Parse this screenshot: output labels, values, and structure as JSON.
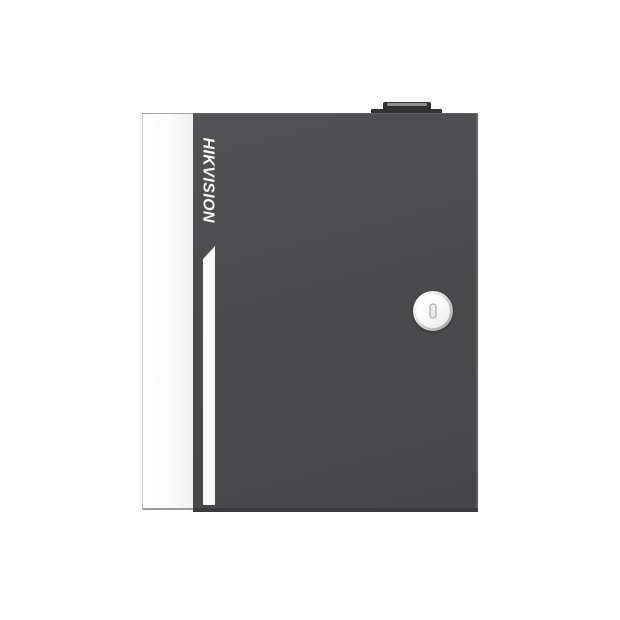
{
  "product": {
    "brand": "HIKVISION"
  },
  "colors": {
    "background": "#ffffff",
    "door": "#4b4b4d",
    "door_bottom_edge": "#3b3b3d",
    "side_panel": "#fbfbfb",
    "panel_border": "#a3a3a3",
    "accent_stripe": "#f6f6f6",
    "brand_text": "#f6f6f6",
    "lock_face": "#e9e9e9",
    "lock_ring": "#9e9e9e",
    "knob_body": "#313133",
    "knob_highlight": "#8f8f8f"
  }
}
